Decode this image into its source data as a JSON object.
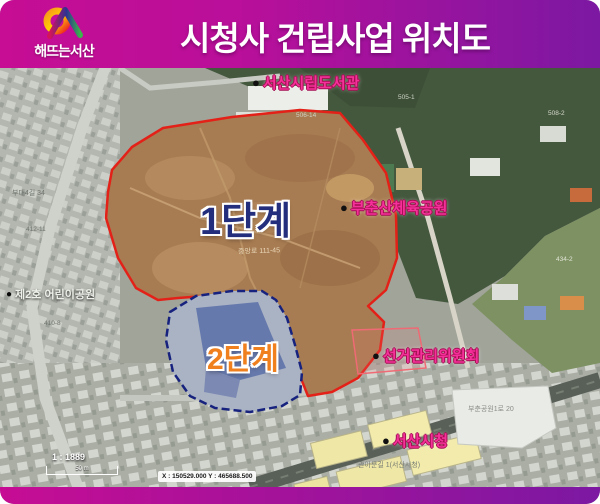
{
  "header": {
    "title": "시청사 건립사업 위치도",
    "logo_text": "해뜨는서산"
  },
  "map": {
    "phase1_label": "1단계",
    "phase2_label": "2단계",
    "poi": [
      {
        "id": "library",
        "bullet": "●",
        "label": "서산시립도서관"
      },
      {
        "id": "sports-park",
        "bullet": "●",
        "label": "부춘산체육공원"
      },
      {
        "id": "election-commission",
        "bullet": "●",
        "label": "선거관리위원회"
      },
      {
        "id": "city-hall",
        "bullet": "●",
        "label": "서산시청"
      },
      {
        "id": "children-park",
        "bullet": "●",
        "label": "제2호 어린이공원"
      }
    ],
    "minor_labels": [
      "중앙로 111-45",
      "부춘공원1로 20",
      "관아문길 1(서산시청)",
      "부대4길 34",
      "412-11",
      "410-8",
      "506-14",
      "505-1",
      "508-2",
      "434-2"
    ],
    "scale": {
      "ratio": "1 : 1889",
      "bar_label": "50 m"
    },
    "coordinates": "X : 150529.000 Y : 465688.500",
    "colors": {
      "header_gradient_left": "#c60d94",
      "header_gradient_right": "#7c18a2",
      "phase1_outline": "#e32118",
      "phase2_outline": "#16227e",
      "phase1_label": "#232e7c",
      "phase2_label": "#f07f1e",
      "poi_label": "#f5309a",
      "phase1_fill": "#a87c52",
      "forest": "#44583e"
    }
  }
}
